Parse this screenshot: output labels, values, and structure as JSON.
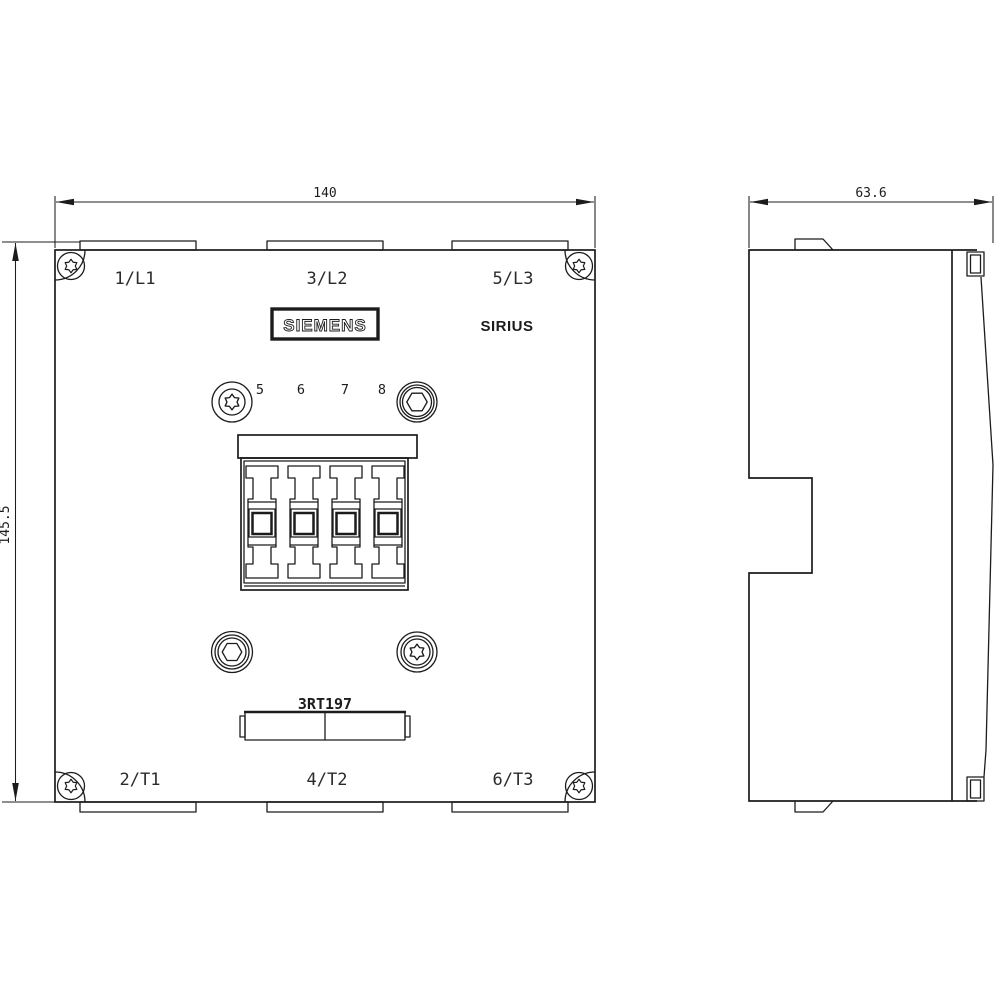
{
  "title": "Siemens SIRIUS 3RT197 dimensional drawing",
  "colors": {
    "line": "#1c1c1c",
    "background": "#ffffff"
  },
  "dimensions": {
    "front_width": "140",
    "front_height": "145.5",
    "side_depth": "63.6"
  },
  "front_view": {
    "brand": "SIEMENS",
    "series": "SIRIUS",
    "model": "3RT197",
    "terminals_top": [
      "1/L1",
      "3/L2",
      "5/L3"
    ],
    "terminals_bottom": [
      "2/T1",
      "4/T2",
      "6/T3"
    ],
    "auxiliary_terminal_numbers": [
      "5",
      "6",
      "7",
      "8"
    ]
  }
}
